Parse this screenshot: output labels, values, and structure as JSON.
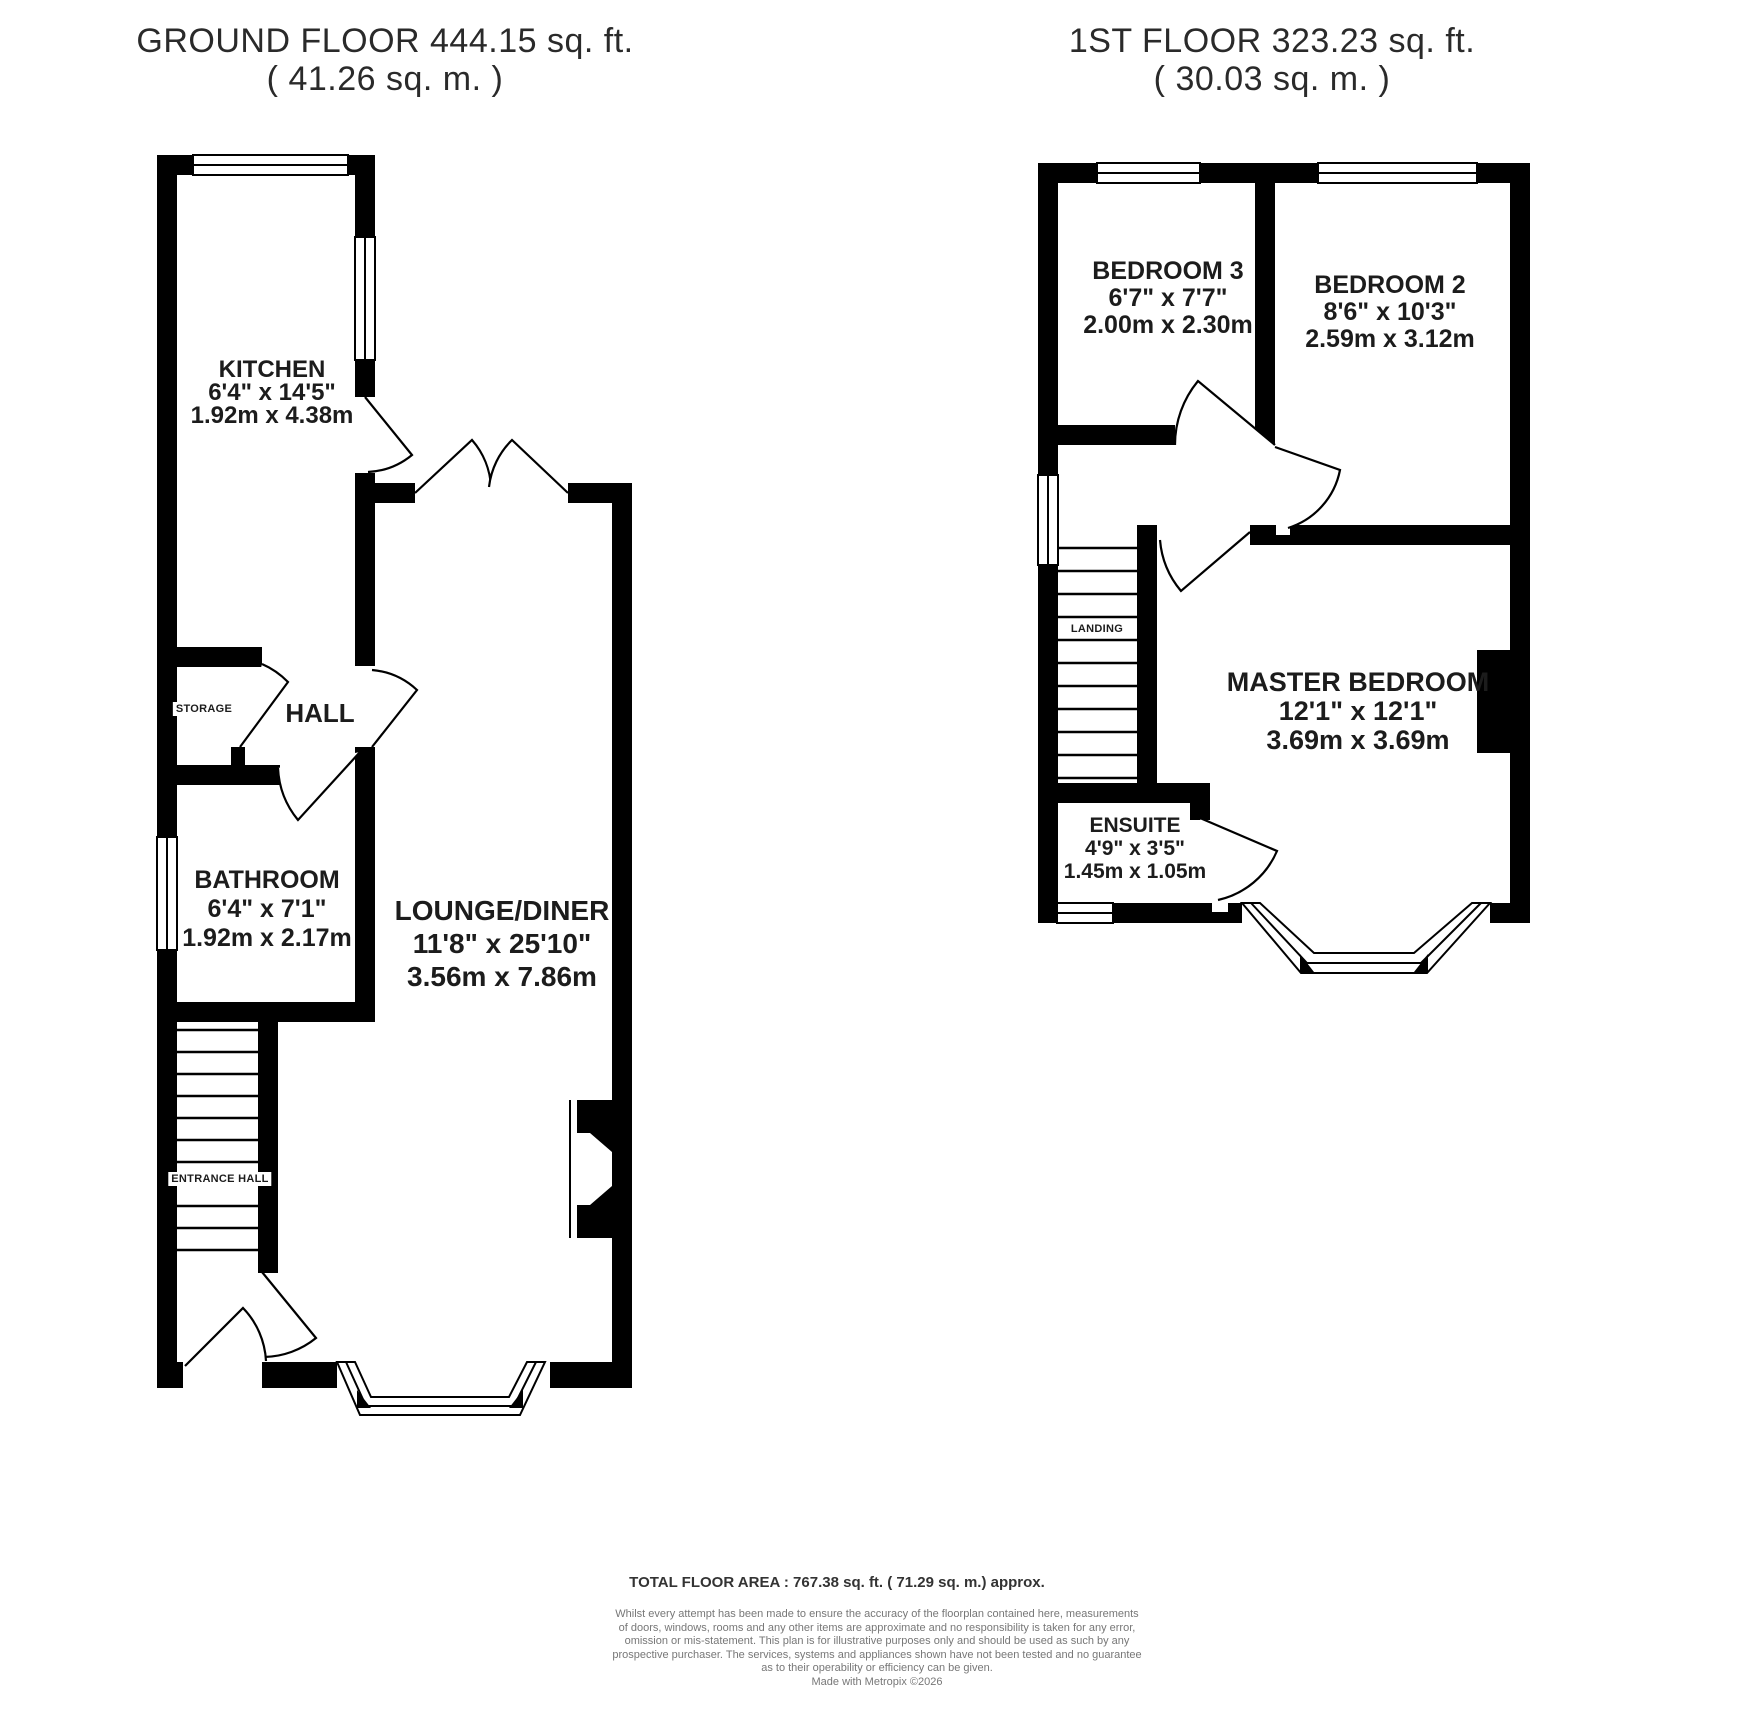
{
  "colors": {
    "walls": "#000000",
    "background": "#ffffff",
    "room_text": "#1c1c1c",
    "disclaimer_text": "#777777"
  },
  "ground_floor": {
    "title": "GROUND FLOOR 444.15 sq. ft.",
    "subtitle": "( 41.26 sq. m. )",
    "rooms": {
      "kitchen": {
        "name": "KITCHEN",
        "imperial": "6'4\" x 14'5\"",
        "metric": "1.92m x 4.38m"
      },
      "storage": {
        "name": "STORAGE"
      },
      "hall": {
        "name": "HALL"
      },
      "bathroom": {
        "name": "BATHROOM",
        "imperial": "6'4\" x 7'1\"",
        "metric": "1.92m x 2.17m"
      },
      "lounge_diner": {
        "name": "LOUNGE/DINER",
        "imperial": "11'8\" x 25'10\"",
        "metric": "3.56m x 7.86m"
      },
      "entrance_hall": {
        "name": "ENTRANCE HALL"
      }
    }
  },
  "first_floor": {
    "title": "1ST FLOOR 323.23 sq. ft.",
    "subtitle": "( 30.03 sq. m. )",
    "rooms": {
      "bedroom3": {
        "name": "BEDROOM 3",
        "imperial": "6'7\" x 7'7\"",
        "metric": "2.00m x 2.30m"
      },
      "bedroom2": {
        "name": "BEDROOM 2",
        "imperial": "8'6\" x 10'3\"",
        "metric": "2.59m x 3.12m"
      },
      "master_bedroom": {
        "name": "MASTER BEDROOM",
        "imperial": "12'1\" x 12'1\"",
        "metric": "3.69m x 3.69m"
      },
      "landing": {
        "name": "LANDING"
      },
      "ensuite": {
        "name": "ENSUITE",
        "imperial": "4'9\" x 3'5\"",
        "metric": "1.45m x 1.05m"
      }
    }
  },
  "footer": {
    "total_area": "TOTAL FLOOR AREA : 767.38 sq. ft. ( 71.29 sq. m.) approx.",
    "disclaimer_lines": [
      "Whilst every attempt has been made to ensure the accuracy of the floorplan contained here, measurements",
      "of doors, windows, rooms and any other items are approximate and no responsibility is taken for any error,",
      "omission or mis-statement. This plan is for illustrative purposes only and should be used as such by any",
      "prospective purchaser. The services, systems and appliances shown have not been tested and no guarantee",
      "as to their operability or efficiency can be given.",
      "Made with Metropix ©2026"
    ]
  }
}
